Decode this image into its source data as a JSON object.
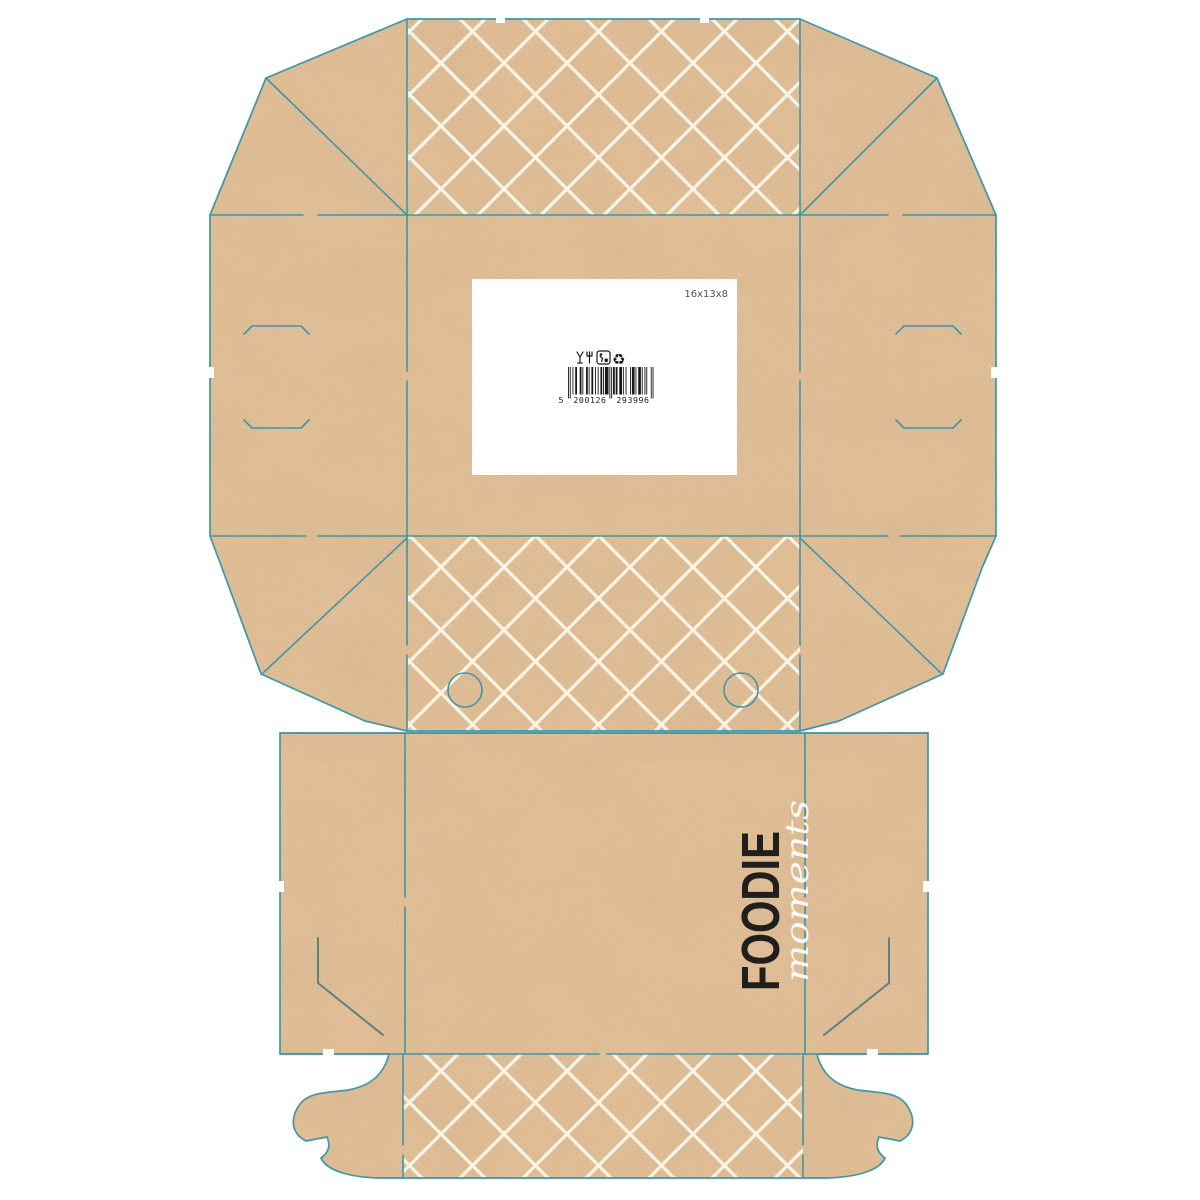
{
  "dieline": {
    "size_label": "16x13x8",
    "brand_primary": "FOODIE",
    "brand_secondary": "moments",
    "barcode": {
      "full": "5200126293996",
      "first_digit": "5",
      "group1": "200126",
      "group2": "293996"
    },
    "symbol_icons": [
      "glass-fork-icon",
      "tidyman-icon",
      "recycle-icon"
    ],
    "colors": {
      "page_bg": "#ffffff",
      "kraft": "#e2bf97",
      "cut_line": "#3e97a5",
      "slit_line": "#5e8083",
      "pattern_white": "#faf4e7",
      "ink": "#201f1d",
      "label_bg": "#ffffff",
      "size_text": "#56524b",
      "barcode_ink": "#1a1a1a"
    }
  }
}
